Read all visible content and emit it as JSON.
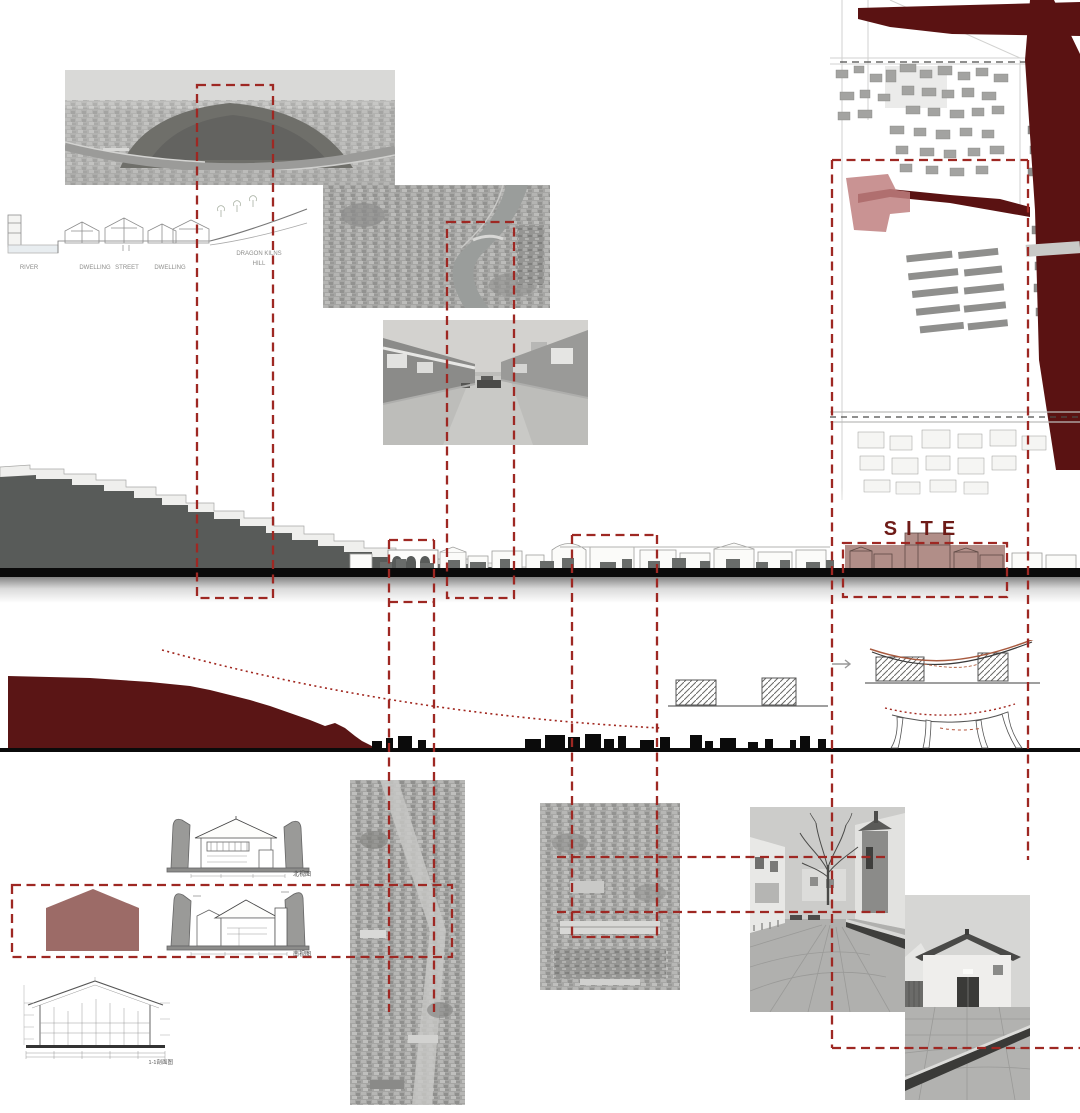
{
  "palette": {
    "maroon_water": "#5a1414",
    "maroon_hill": "#5a1515",
    "dash_red": "#9e2823",
    "dotted_red": "#a1271f",
    "site_fill": "#b18e88",
    "site_text_color": "#6e1b17",
    "hill_gray": "#585b59",
    "ink_black": "#0b0b0b",
    "house_red": "#9c6b67",
    "map_site_pink": "#c08080"
  },
  "section_labels": {
    "river": "RIVER",
    "dwelling_left": "DWELLING",
    "street": "STREET",
    "dwelling_right": "DWELLING",
    "hill_line1": "DRAGON KILNS",
    "hill_line2": "HILL"
  },
  "site_label": "SITE",
  "drawing_labels": {
    "north_elevation": "北视图",
    "south_elevation": "南视图",
    "section_detail": "1-1剖面图"
  }
}
